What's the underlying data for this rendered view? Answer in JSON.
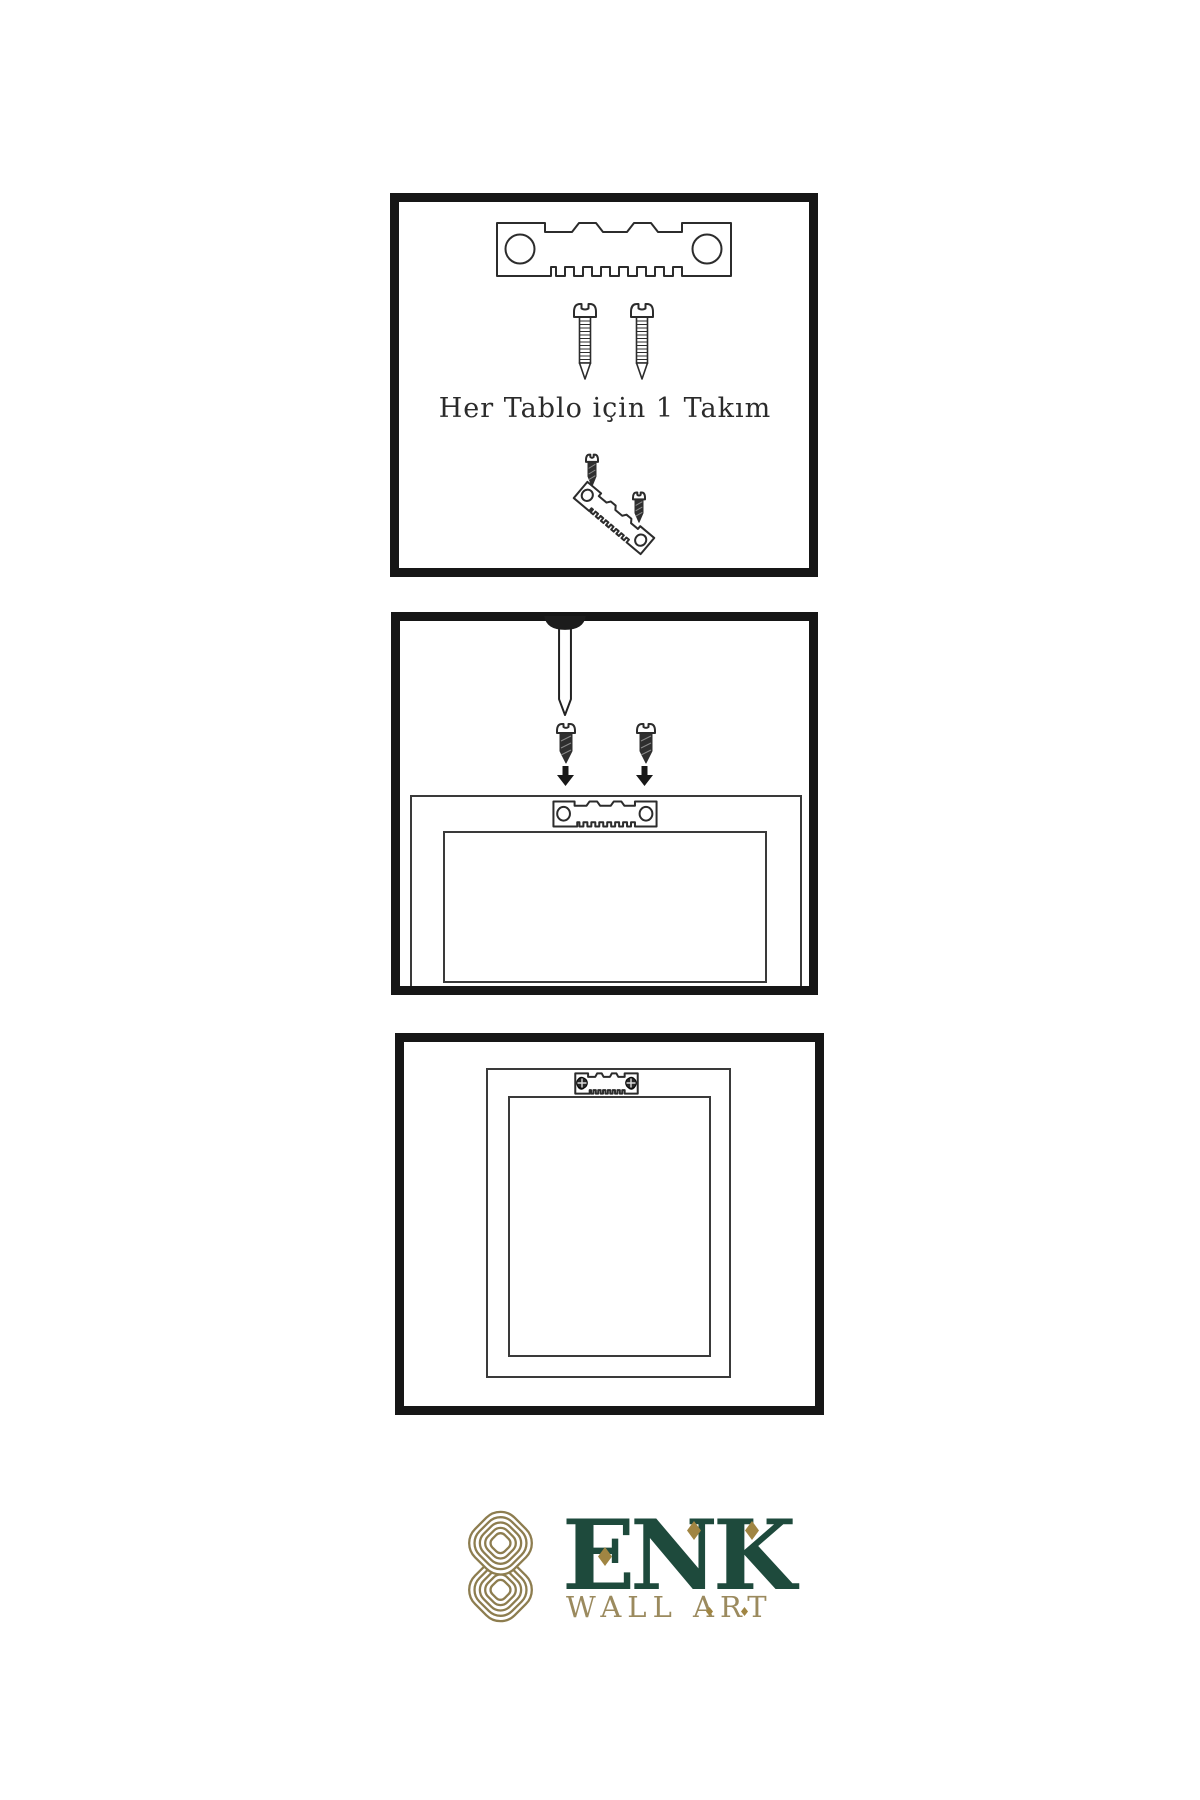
{
  "page": {
    "background": "#FFFFFF"
  },
  "step1": {
    "caption": "Her Tablo için 1 Takım"
  },
  "logo": {
    "brand": "ENK",
    "tagline": "WALL ART",
    "brand_color": "#1E4A3C",
    "tagline_color": "#9B8A5E",
    "knot_color": "#8D7D4F",
    "accent_color": "#A08542"
  },
  "colors": {
    "ink": "#2C2C2C",
    "panel_border": "#161616",
    "background": "#FFFFFF"
  },
  "icons": {
    "sawtooth-hanger-icon": "notched-plate-with-two-holes",
    "screw-icon": "slotted-screw-outline",
    "dark-screw-icon": "slotted-screw-filled",
    "nail-icon": "wall-nail",
    "arrow-down-icon": "▼",
    "screw-head-icon": "⊕",
    "picture-frame-icon": "nested-rectangles",
    "brand-knot-icon": "interlaced-knot"
  }
}
